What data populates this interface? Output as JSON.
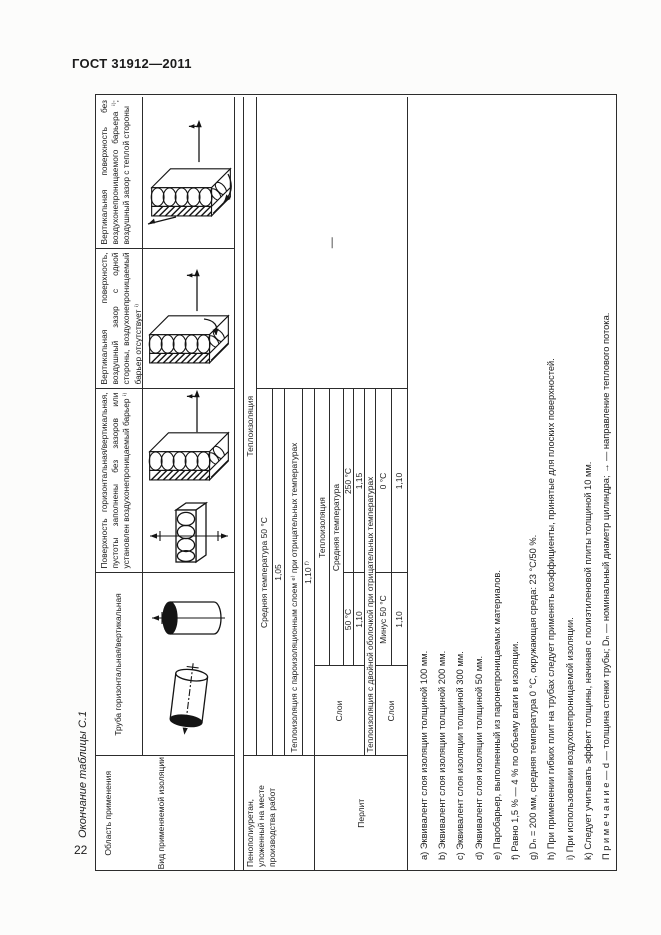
{
  "page": {
    "standard_code": "ГОСТ 31912—2011",
    "table_caption": "Окончание таблицы С.1",
    "page_number": "22"
  },
  "table": {
    "header": {
      "application_label": "Область применения",
      "insulation_type_label": "Вид применяемой изоляции",
      "col_pipe": "Труба горизонтальная/вертикальная",
      "col_surface": "Поверхность горизонтальная/вертикальная, пустоты заполнены без зазоров или установлен воздухонепроницаемый барьер ⁱ⁾",
      "col_vertical_gap": "Вертикальная поверхность, воздушный зазор с одной стороны, воздухонепроницаемый барьер отсутствует ⁱ⁾",
      "col_vertical_no_barrier": "Вертикальная поверхность без воздухонепроницаемого барьера ⁱ⁾; воздушный зазор с теплой стороны"
    },
    "body": {
      "pu": {
        "application": "Пенополиуретан, уложенный на месте производства работ",
        "insulation_heading": "Теплоизоляция",
        "avg_temp_row_label": "Средняя температура 50 °С",
        "avg_temp_row_value": "1,05",
        "vapor_row_label": "Теплоизоляция с пароизоляционным слоем ᵉ⁾ при отрицательных температурах",
        "vapor_row_value": "1,10 ᶠ⁾"
      },
      "perlite": {
        "application": "Перлит",
        "layers_label": "Слои",
        "insulation_heading": "Теплоизоляция",
        "avg_temp_label": "Средняя температура",
        "temp1": "50 °С",
        "temp1_value": "1,10",
        "temp2": "250 °С",
        "temp2_value": "1,15",
        "double_shell_label": "Теплоизоляция с двойной оболочкой при отрицательных температурах",
        "layers2_label": "Слои",
        "temp3": "Минус 50 °С",
        "temp3_value": "1,10",
        "temp4": "0 °С",
        "temp4_value": "1,10"
      },
      "no_data": "—"
    },
    "footnotes": [
      "a) Эквивалент слоя изоляции толщиной 100 мм.",
      "b) Эквивалент слоя изоляции толщиной 200 мм.",
      "c) Эквивалент слоя изоляции толщиной 300 мм.",
      "d) Эквивалент слоя изоляции толщиной 50 мм.",
      "e) Паробарьер, выполненный из паронепроницаемых материалов.",
      "f) Равно 1,5 % — 4 % по объему влаги в изоляции.",
      "g) Dₙ = 200 мм, средняя температура 0 °С, окружающая среда: 23 °С/50 %.",
      "h) При применении гибких плит на трубах следует применять коэффициенты, принятые для плоских поверхностей.",
      "i) При использовании воздухонепроницаемой изоляции.",
      "k) Следует учитывать эффект толщины, начиная с полиэтиленовой плиты толщиной 10 мм."
    ],
    "note": "П р и м е ч а н и е — d — толщина стенки трубы; Dₙ — номинальный диаметр цилиндра; → — направление теплового потока."
  }
}
